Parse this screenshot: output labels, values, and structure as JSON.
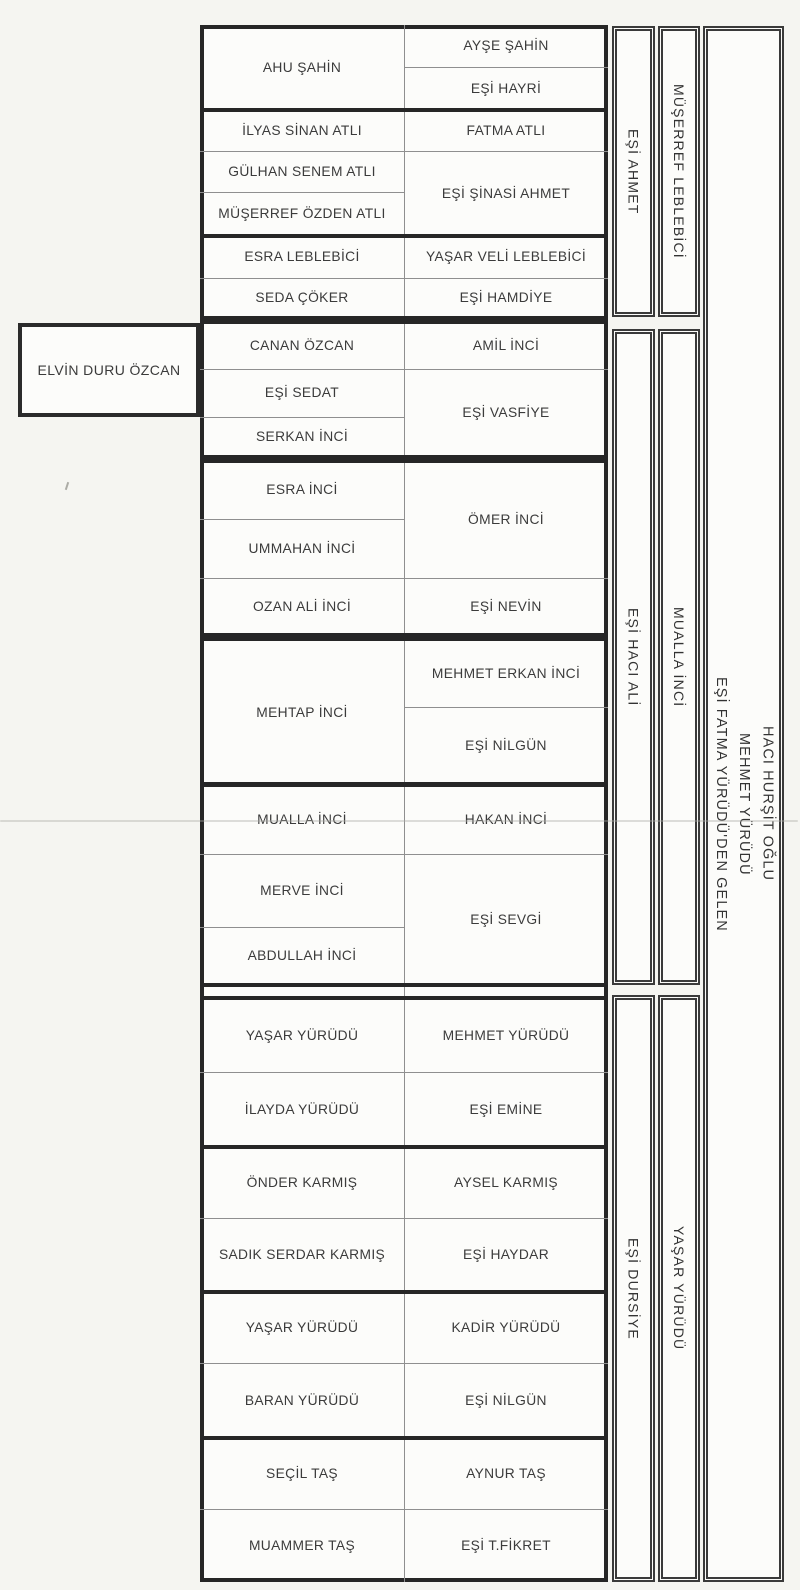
{
  "document": {
    "kind": "scanned family tree page (Turkish)",
    "paper_color": "#f5f5f1",
    "ink_color": "#2b2b2b"
  },
  "standalone_box": {
    "label": "ELVİN DURU ÖZCAN"
  },
  "main_table": {
    "columns": 2,
    "blocks": [
      {
        "left": [
          "AHU ŞAHİN"
        ],
        "right": [
          "AYŞE ŞAHİN",
          "EŞİ HAYRİ"
        ]
      },
      {
        "left": [
          "İLYAS SİNAN ATLI",
          "GÜLHAN SENEM ATLI",
          "MÜŞERREF ÖZDEN ATLI"
        ],
        "right": [
          "FATMA ATLI",
          "EŞİ ŞİNASİ AHMET"
        ]
      },
      {
        "left": [
          "ESRA LEBLEBİCİ",
          "SEDA ÇÖKER"
        ],
        "right": [
          "YAŞAR VELİ LEBLEBİCİ",
          "EŞİ HAMDİYE"
        ]
      },
      {
        "left": [
          "CANAN ÖZCAN",
          "EŞİ SEDAT",
          "SERKAN İNCİ"
        ],
        "right": [
          "AMİL İNCİ",
          "EŞİ VASFİYE"
        ]
      },
      {
        "left": [
          "ESRA İNCİ",
          "UMMAHAN İNCİ",
          "OZAN ALİ İNCİ"
        ],
        "right": [
          "ÖMER İNCİ",
          "EŞİ NEVİN"
        ]
      },
      {
        "left": [
          "MEHTAP İNCİ"
        ],
        "right": [
          "MEHMET ERKAN İNCİ",
          "EŞİ NİLGÜN"
        ]
      },
      {
        "left": [
          "MUALLA İNCİ",
          "MERVE İNCİ",
          "ABDULLAH İNCİ"
        ],
        "right": [
          "HAKAN İNCİ",
          "EŞİ SEVGİ"
        ]
      },
      {
        "left": [
          "YAŞAR YÜRÜDÜ",
          "İLAYDA YÜRÜDÜ"
        ],
        "right": [
          "MEHMET YÜRÜDÜ",
          "EŞİ EMİNE"
        ]
      },
      {
        "left": [
          "ÖNDER KARMIŞ",
          "SADIK SERDAR KARMIŞ"
        ],
        "right": [
          "AYSEL KARMIŞ",
          "EŞİ HAYDAR"
        ]
      },
      {
        "left": [
          "YAŞAR YÜRÜDÜ",
          "BARAN YÜRÜDÜ"
        ],
        "right": [
          "KADİR YÜRÜDÜ",
          "EŞİ NİLGÜN"
        ]
      },
      {
        "left": [
          "SEÇİL TAŞ",
          "MUAMMER TAŞ"
        ],
        "right": [
          "AYNUR TAŞ",
          "EŞİ T.FİKRET"
        ]
      }
    ]
  },
  "side_columns": {
    "sections": [
      {
        "spouse": "EŞİ AHMET",
        "head": "MÜŞERREF LEBLEBİCİ"
      },
      {
        "spouse": "EŞİ HACI ALİ",
        "head": "MUALLA İNCİ"
      },
      {
        "spouse": "EŞİ DURSİYE",
        "head": "YAŞAR YÜRÜDÜ"
      }
    ],
    "origin": {
      "lines": [
        "HACI HURŞİT OĞLU",
        "MEHMET YÜRÜDÜ",
        "EŞİ FATMA YÜRÜDÜ'DEN GELEN"
      ]
    }
  }
}
